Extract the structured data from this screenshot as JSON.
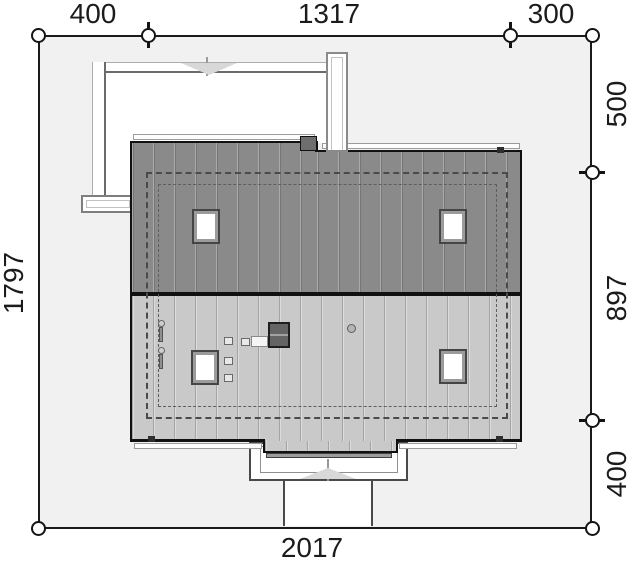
{
  "drawing": {
    "kind": "house-plot-roof-plan",
    "dimension_labels": {
      "top": [
        "400",
        "1317",
        "300"
      ],
      "left": [
        "1797"
      ],
      "right": [
        "500",
        "897",
        "400"
      ],
      "bottom": [
        "2017"
      ]
    },
    "colors": {
      "plot_fill": "#f1f1f1",
      "roof_upper_slope": "#8a8a8a",
      "roof_lower_slope": "#c9c9c9",
      "paving": "#ffffff",
      "outline": "#1a1a1a"
    }
  }
}
